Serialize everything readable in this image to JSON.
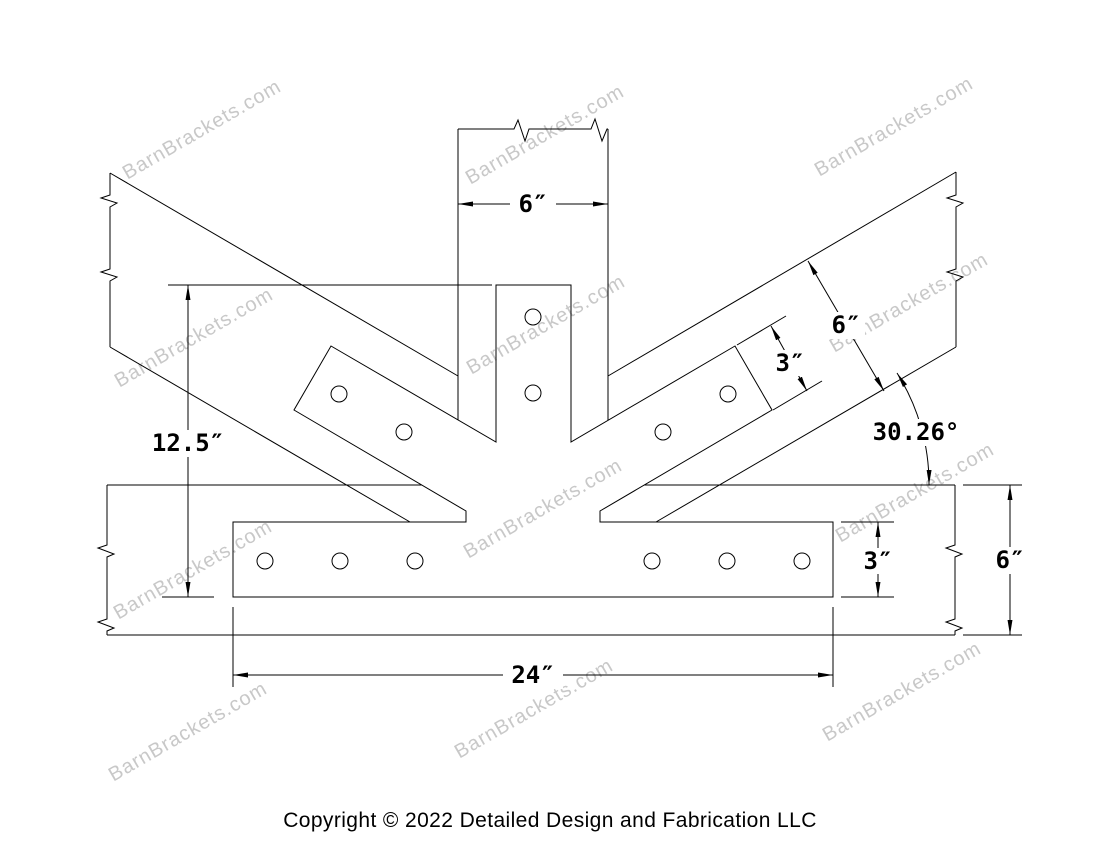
{
  "page": {
    "background": "#ffffff",
    "line_color": "#000000",
    "watermark_color": "#c8c8c8"
  },
  "drawing": {
    "watermark_text": "BarnBrackets.com",
    "copyright": "Copyright © 2022 Detailed Design and Fabrication LLC",
    "bolt_hole_count": 12,
    "dimensions": {
      "post_width": "6″",
      "bracket_height": "12.5″",
      "arm_width": "3″",
      "rafter_width": "6″",
      "rafter_angle": "30.26°",
      "plate_height": "3″",
      "beam_height": "6″",
      "plate_width": "24″"
    }
  }
}
